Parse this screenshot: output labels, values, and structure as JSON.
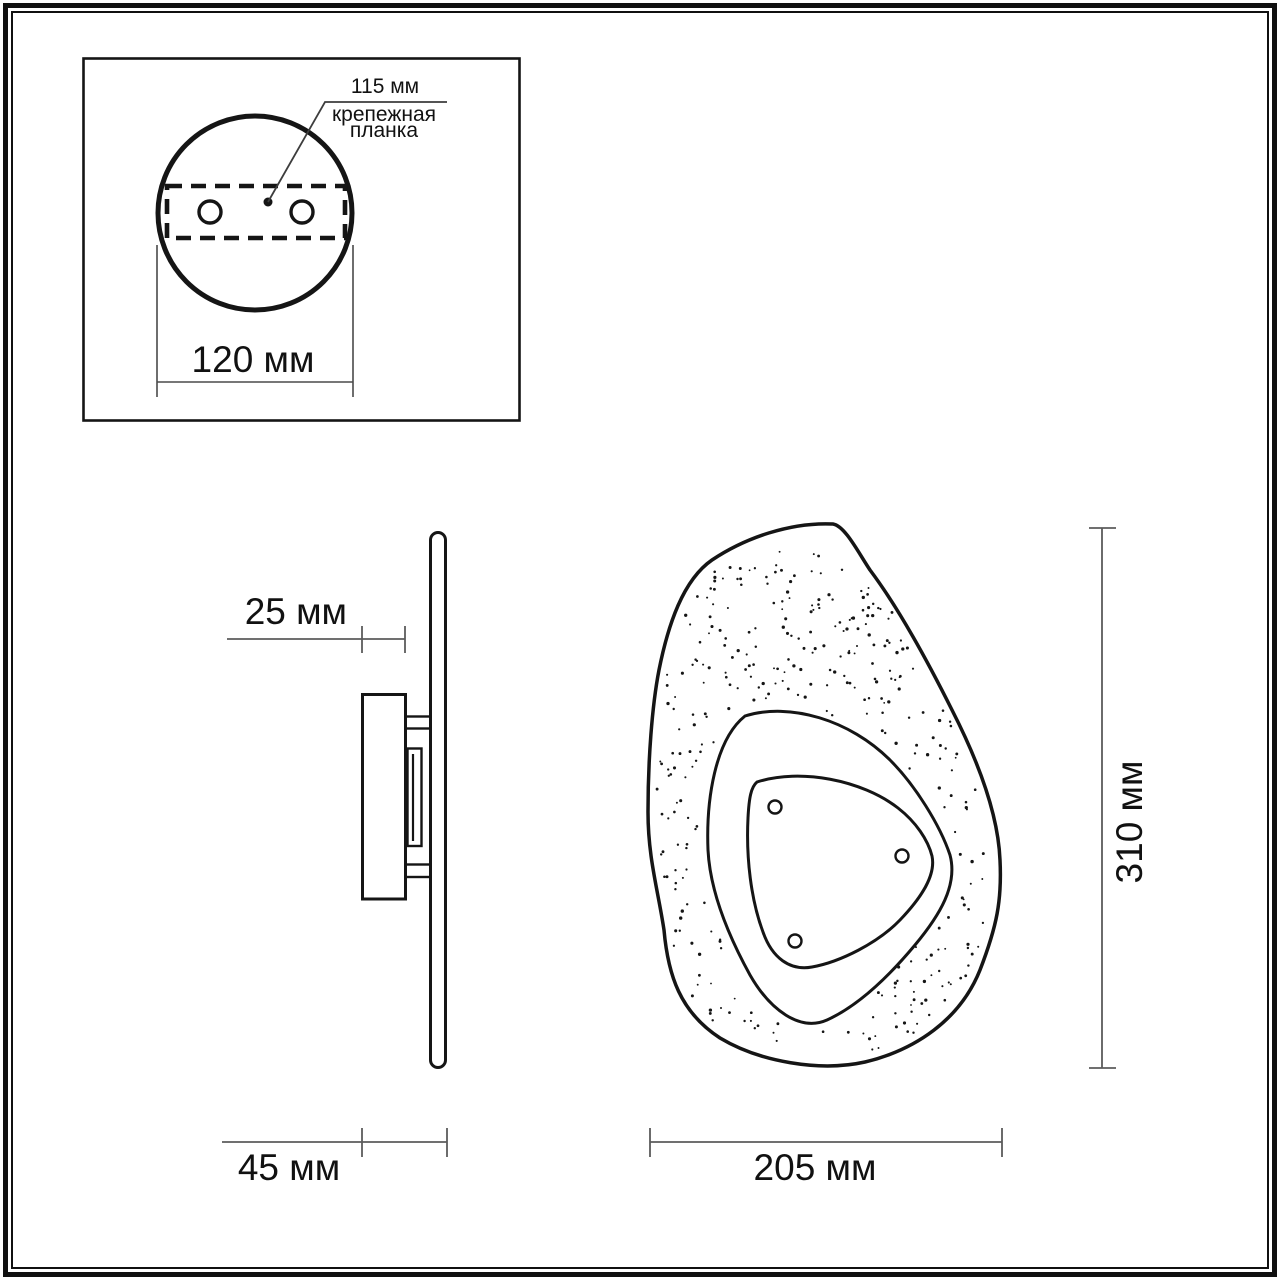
{
  "inset": {
    "hole_spacing_label": "115 мм",
    "mount_bar_label_line1": "крепежная",
    "mount_bar_label_line2": "планка",
    "base_diameter_label": "120 мм"
  },
  "side_view": {
    "plate_depth_label": "25 мм",
    "total_depth_label": "45 мм"
  },
  "front_view": {
    "width_label": "205 мм",
    "height_label": "310 мм"
  },
  "colors": {
    "outline": "#151515",
    "dimension_line": "#5b5b5b",
    "leader_line": "#3d3d3d",
    "text": "#111111",
    "background": "#ffffff"
  }
}
